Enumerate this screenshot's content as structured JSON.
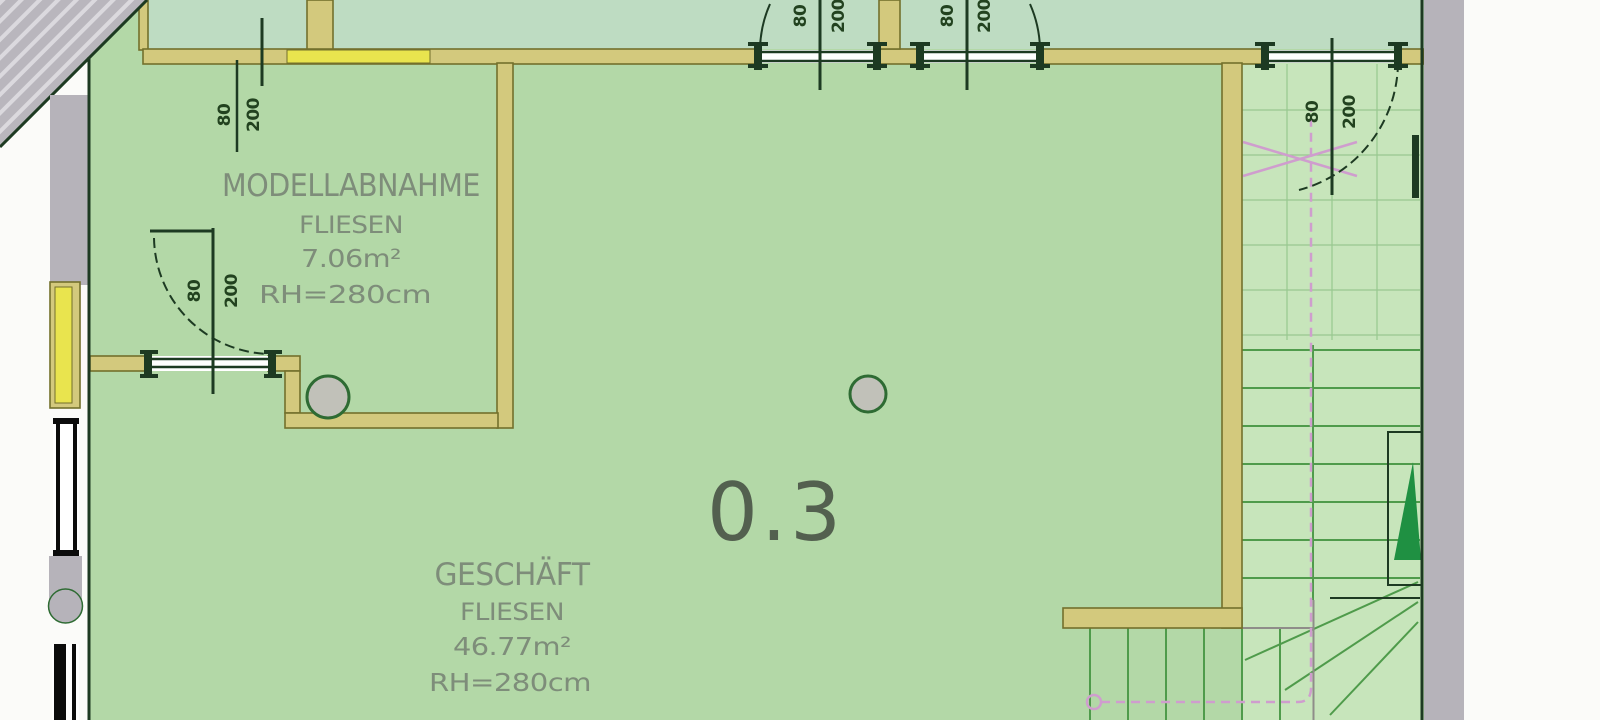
{
  "plan": {
    "rooms": [
      {
        "name": "MODELLABNAHME",
        "finish": "FLIESEN",
        "area": "7.06m²",
        "height": "RH=280cm"
      },
      {
        "name": "GESCHÄFT",
        "finish": "FLIESEN",
        "area": "46.77m²",
        "height": "RH=280cm"
      }
    ],
    "room_number": "0.3",
    "doors": [
      {
        "width": "80",
        "height": "200"
      },
      {
        "width": "80",
        "height": "200"
      },
      {
        "width": "80",
        "height": "200"
      },
      {
        "width": "80",
        "height": "200"
      },
      {
        "width": "80",
        "height": "200"
      }
    ]
  },
  "colors": {
    "page_bg": "#fbfbf9",
    "floor": "#b3d8a7",
    "floor_upper": "#bedcc2",
    "stair_floor": "#c7e5bb",
    "wall_tan": "#d3c97d",
    "wall_tan_dark": "#73702c",
    "wall_bright": "#e9e44e",
    "gray_wall": "#b6b3ba",
    "gray_hatch": "#dbd9de",
    "line_dark": "#1d3a22",
    "tread_green": "#4f9b4b",
    "tile_green": "#98c88f",
    "pink": "#cf9dce",
    "triangle_green": "#1f9042",
    "column_fill": "#c1c1b9",
    "column_ring": "#2e6b33",
    "text_room": "#7e8d7a",
    "text_number": "#53604f",
    "text_dim": "#22421f",
    "window_black": "#0c0c0c",
    "window_white": "#ffffff"
  }
}
